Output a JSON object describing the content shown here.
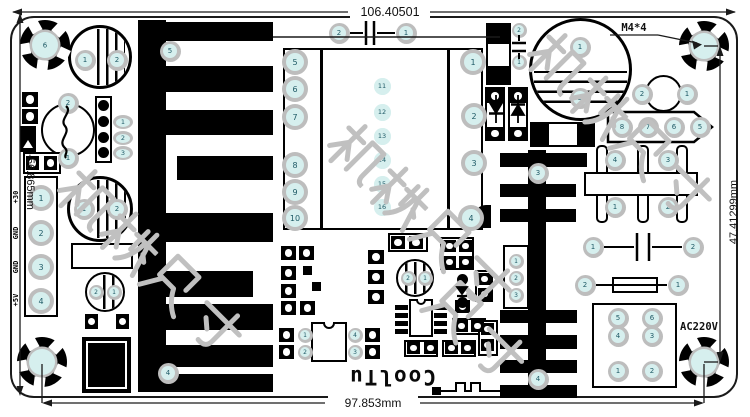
{
  "dimensions": {
    "top": "106.40501",
    "bottom": "97.853mm",
    "left": "-56.865mm",
    "right": "47.41299mm"
  },
  "labels": {
    "mount_spec": "M4*4",
    "ac_input": "AC220V",
    "brand": "CoolTu",
    "output_pins": [
      "+30",
      "GND",
      "GND",
      "+5V"
    ]
  },
  "watermark": {
    "color": "#c0c0c0",
    "strings": [
      {
        "text": "机械尺寸",
        "x": 355,
        "y": 106,
        "size": 62
      },
      {
        "text": "机械尺寸",
        "x": 85,
        "y": 151,
        "size": 62
      },
      {
        "text": "机械尺寸",
        "x": 555,
        "y": 15,
        "size": 62
      },
      {
        "text": "尺寸",
        "x": 455,
        "y": 265,
        "size": 62
      }
    ]
  },
  "colors": {
    "pad_ring": "#bdbdbd",
    "pad_center": "#d6efee",
    "silk": "#111111",
    "board_bg": "#ffffff"
  },
  "mount_holes": [
    {
      "x": 45,
      "y": 45,
      "n": "6"
    },
    {
      "x": 704,
      "y": 46,
      "n": ""
    },
    {
      "x": 42,
      "y": 362,
      "n": ""
    },
    {
      "x": 704,
      "y": 362,
      "n": ""
    }
  ],
  "pads": [
    {
      "n": "2",
      "x": 339,
      "y": 33,
      "s": "md"
    },
    {
      "n": "1",
      "x": 406,
      "y": 33,
      "s": "md"
    },
    {
      "n": "1",
      "x": 85,
      "y": 60,
      "s": "md"
    },
    {
      "n": "2",
      "x": 117,
      "y": 60,
      "s": "md"
    },
    {
      "n": "5",
      "x": 170,
      "y": 51,
      "s": "md"
    },
    {
      "n": "4",
      "x": 168,
      "y": 373,
      "s": "md"
    },
    {
      "n": "2",
      "x": 68,
      "y": 103,
      "s": "md"
    },
    {
      "n": "1",
      "x": 68,
      "y": 158,
      "s": "md"
    },
    {
      "n": "1",
      "x": 123,
      "y": 122,
      "s": "o"
    },
    {
      "n": "2",
      "x": 123,
      "y": 138,
      "s": "o"
    },
    {
      "n": "3",
      "x": 123,
      "y": 153,
      "s": "o"
    },
    {
      "n": "1",
      "x": 41,
      "y": 198,
      "s": "lg"
    },
    {
      "n": "2",
      "x": 41,
      "y": 233,
      "s": "lg"
    },
    {
      "n": "3",
      "x": 41,
      "y": 267,
      "s": "lg"
    },
    {
      "n": "4",
      "x": 41,
      "y": 301,
      "s": "lg"
    },
    {
      "n": "1",
      "x": 84,
      "y": 209,
      "s": "md"
    },
    {
      "n": "2",
      "x": 117,
      "y": 209,
      "s": "md"
    },
    {
      "n": "2",
      "x": 96,
      "y": 292,
      "s": "sm"
    },
    {
      "n": "1",
      "x": 114,
      "y": 292,
      "s": "sm"
    },
    {
      "n": "5",
      "x": 295,
      "y": 62,
      "s": "lg"
    },
    {
      "n": "6",
      "x": 295,
      "y": 89,
      "s": "lg"
    },
    {
      "n": "7",
      "x": 295,
      "y": 117,
      "s": "lg"
    },
    {
      "n": "8",
      "x": 295,
      "y": 165,
      "s": "lg"
    },
    {
      "n": "9",
      "x": 295,
      "y": 192,
      "s": "lg"
    },
    {
      "n": "10",
      "x": 295,
      "y": 218,
      "s": "lg"
    },
    {
      "n": "1",
      "x": 473,
      "y": 62,
      "s": "lg"
    },
    {
      "n": "2",
      "x": 474,
      "y": 116,
      "s": "lg"
    },
    {
      "n": "3",
      "x": 474,
      "y": 163,
      "s": "lg"
    },
    {
      "n": "4",
      "x": 471,
      "y": 218,
      "s": "lg"
    },
    {
      "n": "11",
      "x": 382,
      "y": 86,
      "s": "t"
    },
    {
      "n": "12",
      "x": 382,
      "y": 112,
      "s": "t"
    },
    {
      "n": "13",
      "x": 382,
      "y": 136,
      "s": "t"
    },
    {
      "n": "14",
      "x": 382,
      "y": 160,
      "s": "t"
    },
    {
      "n": "15",
      "x": 382,
      "y": 184,
      "s": "t"
    },
    {
      "n": "16",
      "x": 382,
      "y": 207,
      "s": "t"
    },
    {
      "n": "2",
      "x": 519,
      "y": 30,
      "s": "sm"
    },
    {
      "n": "1",
      "x": 519,
      "y": 62,
      "s": "sm"
    },
    {
      "n": "1",
      "x": 580,
      "y": 47,
      "s": "md"
    },
    {
      "n": "2",
      "x": 580,
      "y": 98,
      "s": "md"
    },
    {
      "n": "3",
      "x": 538,
      "y": 173,
      "s": "md"
    },
    {
      "n": "4",
      "x": 538,
      "y": 379,
      "s": "md"
    },
    {
      "n": "1",
      "x": 516,
      "y": 261,
      "s": "sm"
    },
    {
      "n": "2",
      "x": 516,
      "y": 278,
      "s": "sm"
    },
    {
      "n": "3",
      "x": 516,
      "y": 295,
      "s": "sm"
    },
    {
      "n": "2",
      "x": 642,
      "y": 94,
      "s": "md"
    },
    {
      "n": "1",
      "x": 687,
      "y": 94,
      "s": "md"
    },
    {
      "n": "8",
      "x": 622,
      "y": 127,
      "s": "md"
    },
    {
      "n": "7",
      "x": 648,
      "y": 127,
      "s": "md"
    },
    {
      "n": "6",
      "x": 674,
      "y": 127,
      "s": "md"
    },
    {
      "n": "5",
      "x": 700,
      "y": 127,
      "s": "md"
    },
    {
      "n": "4",
      "x": 615,
      "y": 160,
      "s": "md"
    },
    {
      "n": "3",
      "x": 668,
      "y": 160,
      "s": "md"
    },
    {
      "n": "1",
      "x": 615,
      "y": 207,
      "s": "md"
    },
    {
      "n": "2",
      "x": 668,
      "y": 207,
      "s": "md"
    },
    {
      "n": "1",
      "x": 593,
      "y": 247,
      "s": "md"
    },
    {
      "n": "2",
      "x": 693,
      "y": 247,
      "s": "md"
    },
    {
      "n": "2",
      "x": 585,
      "y": 285,
      "s": "md"
    },
    {
      "n": "1",
      "x": 678,
      "y": 285,
      "s": "md"
    },
    {
      "n": "5",
      "x": 618,
      "y": 318,
      "s": "md"
    },
    {
      "n": "6",
      "x": 652,
      "y": 318,
      "s": "md"
    },
    {
      "n": "4",
      "x": 618,
      "y": 336,
      "s": "md"
    },
    {
      "n": "3",
      "x": 652,
      "y": 336,
      "s": "md"
    },
    {
      "n": "1",
      "x": 618,
      "y": 371,
      "s": "md"
    },
    {
      "n": "2",
      "x": 652,
      "y": 371,
      "s": "md"
    },
    {
      "n": "2",
      "x": 408,
      "y": 278,
      "s": "sm"
    },
    {
      "n": "1",
      "x": 425,
      "y": 278,
      "s": "sm"
    },
    {
      "n": "1",
      "x": 305,
      "y": 335,
      "s": "sm"
    },
    {
      "n": "2",
      "x": 305,
      "y": 352,
      "s": "sm"
    },
    {
      "n": "4",
      "x": 355,
      "y": 335,
      "s": "sm"
    },
    {
      "n": "3",
      "x": 355,
      "y": 352,
      "s": "sm"
    }
  ],
  "footprints": {
    "boxes": [
      [
        23,
        152,
        38,
        22
      ],
      [
        95,
        96,
        17,
        67
      ],
      [
        71,
        243,
        62,
        26
      ],
      [
        530,
        122,
        65,
        25
      ],
      [
        486,
        23,
        25,
        62
      ],
      [
        485,
        87,
        20,
        54
      ],
      [
        508,
        87,
        20,
        54
      ],
      [
        388,
        233,
        40,
        19
      ],
      [
        440,
        237,
        34,
        33
      ],
      [
        475,
        270,
        18,
        32
      ],
      [
        404,
        340,
        34,
        17
      ],
      [
        452,
        318,
        34,
        17
      ],
      [
        442,
        340,
        34,
        17
      ],
      [
        478,
        320,
        20,
        36
      ],
      [
        612,
        277,
        46,
        16
      ]
    ],
    "bpads": [
      [
        22,
        92,
        16,
        15
      ],
      [
        22,
        109,
        16,
        15
      ],
      [
        26,
        156,
        13,
        14
      ],
      [
        44,
        156,
        13,
        14
      ],
      [
        391,
        236,
        14,
        13
      ],
      [
        409,
        236,
        14,
        13
      ],
      [
        443,
        240,
        13,
        12
      ],
      [
        459,
        240,
        13,
        12
      ],
      [
        443,
        256,
        13,
        12
      ],
      [
        459,
        256,
        13,
        12
      ],
      [
        478,
        273,
        13,
        12
      ],
      [
        478,
        288,
        13,
        12
      ],
      [
        368,
        250,
        16,
        14
      ],
      [
        368,
        270,
        16,
        14
      ],
      [
        368,
        290,
        16,
        14
      ],
      [
        281,
        246,
        15,
        14
      ],
      [
        299,
        246,
        15,
        14
      ],
      [
        281,
        266,
        15,
        14
      ],
      [
        281,
        284,
        15,
        14
      ],
      [
        281,
        301,
        15,
        14
      ],
      [
        300,
        301,
        15,
        14
      ],
      [
        279,
        328,
        15,
        14
      ],
      [
        279,
        345,
        15,
        14
      ],
      [
        365,
        328,
        15,
        14
      ],
      [
        365,
        345,
        15,
        14
      ],
      [
        455,
        300,
        15,
        13
      ],
      [
        407,
        342,
        13,
        12
      ],
      [
        424,
        342,
        13,
        12
      ],
      [
        455,
        320,
        13,
        12
      ],
      [
        471,
        320,
        13,
        12
      ],
      [
        445,
        342,
        13,
        12
      ],
      [
        461,
        342,
        13,
        12
      ],
      [
        481,
        323,
        13,
        12
      ],
      [
        481,
        339,
        13,
        12
      ],
      [
        487,
        89,
        16,
        14
      ],
      [
        487,
        127,
        16,
        13
      ],
      [
        510,
        89,
        16,
        14
      ],
      [
        510,
        127,
        16,
        13
      ],
      [
        85,
        314,
        13,
        15
      ],
      [
        116,
        314,
        13,
        15
      ]
    ],
    "solids": [
      [
        488,
        25,
        21,
        19
      ],
      [
        488,
        66,
        21,
        19
      ],
      [
        532,
        124,
        17,
        21
      ],
      [
        577,
        124,
        16,
        21
      ],
      [
        303,
        266,
        9,
        9
      ],
      [
        312,
        282,
        9,
        9
      ],
      [
        432,
        387,
        9,
        8
      ],
      [
        520,
        387,
        9,
        8
      ]
    ],
    "bdots": [
      [
        103,
        105,
        11
      ],
      [
        103,
        121,
        11
      ],
      [
        103,
        137,
        11
      ],
      [
        103,
        152,
        11
      ],
      [
        462,
        279,
        11
      ],
      [
        462,
        302,
        11
      ]
    ]
  }
}
